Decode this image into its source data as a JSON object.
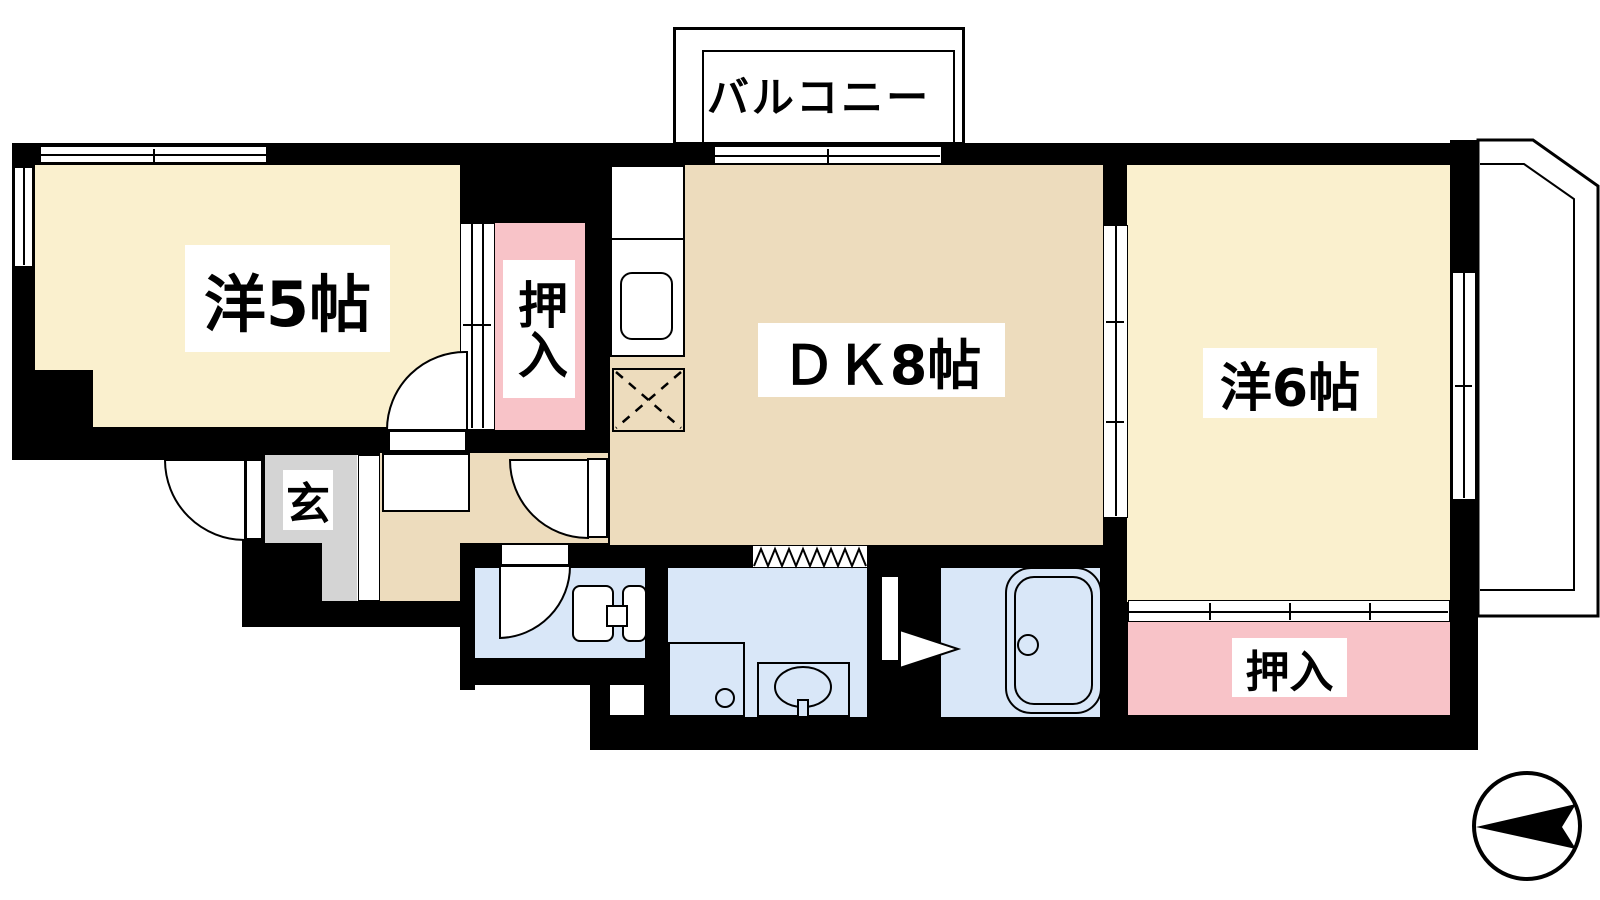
{
  "title": "2DK apartment floor plan",
  "rooms": {
    "western5": {
      "label": "洋5帖",
      "color": "#FAF0CE",
      "type": "western room 5 mats"
    },
    "dk": {
      "label": "ＤＫ8帖",
      "color": "#EDDCBD",
      "type": "dining kitchen 8 mats"
    },
    "western6": {
      "label": "洋6帖",
      "color": "#FAF0CE",
      "type": "western room 6 mats"
    },
    "closet_left": {
      "label": "押入",
      "color": "#F8C3C8",
      "type": "futon closet"
    },
    "closet_bottom": {
      "label": "押入",
      "color": "#F8C3C8",
      "type": "futon closet"
    },
    "entrance": {
      "label": "玄",
      "color": "#D4D4D4",
      "type": "genkan entrance"
    },
    "balcony_top": {
      "label": "バルコニー"
    },
    "balcony_right": {
      "label": "バルコニー"
    },
    "washroom": {
      "color": "#D9E7F8"
    },
    "toilet_room": {
      "color": "#D9E7F8"
    },
    "bathroom": {
      "color": "#D9E7F8"
    }
  },
  "fixtures": {
    "kitchen_counter": "kitchen counter with sink",
    "refrigerator_space": "refrigerator space (dashed X)",
    "washing_machine": "washing machine pan",
    "toilet": "toilet with tank circle",
    "wash_basin": "wash basin with tap",
    "bathtub": "bathtub with drain",
    "compass": "north arrow pointing left"
  },
  "colors": {
    "wall": "#000000",
    "room_cream": "#FAF0CE",
    "room_tan": "#EDDCBD",
    "closet_pink": "#F8C3C8",
    "wet_blue": "#D9E7F8",
    "entrance_gray": "#D4D4D4",
    "background": "#FFFFFF"
  }
}
